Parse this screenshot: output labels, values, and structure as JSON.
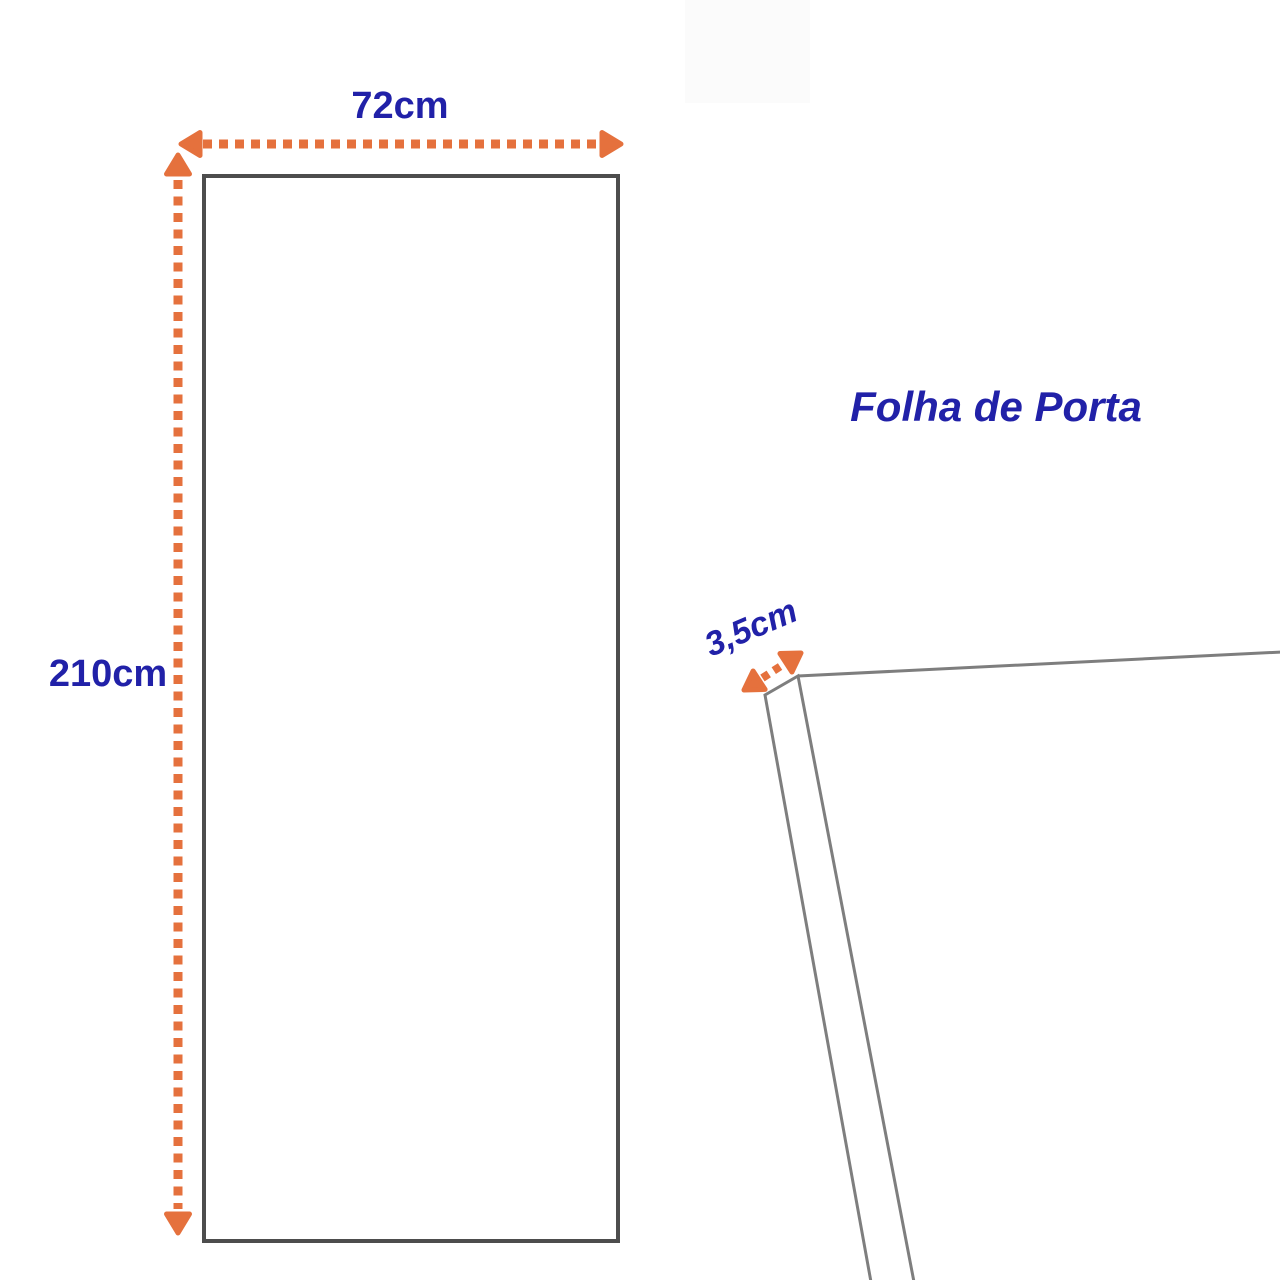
{
  "colors": {
    "dimension": "#E5713D",
    "label": "#2121A8",
    "door-outline": "#4D4D4D",
    "edge-line": "#7E7E7E",
    "background": "#FFFFFF"
  },
  "diagram": {
    "title": "Folha de Porta",
    "door_front": {
      "width_label": "72cm",
      "height_label": "210cm"
    },
    "door_edge": {
      "thickness_label": "3,5cm"
    }
  }
}
